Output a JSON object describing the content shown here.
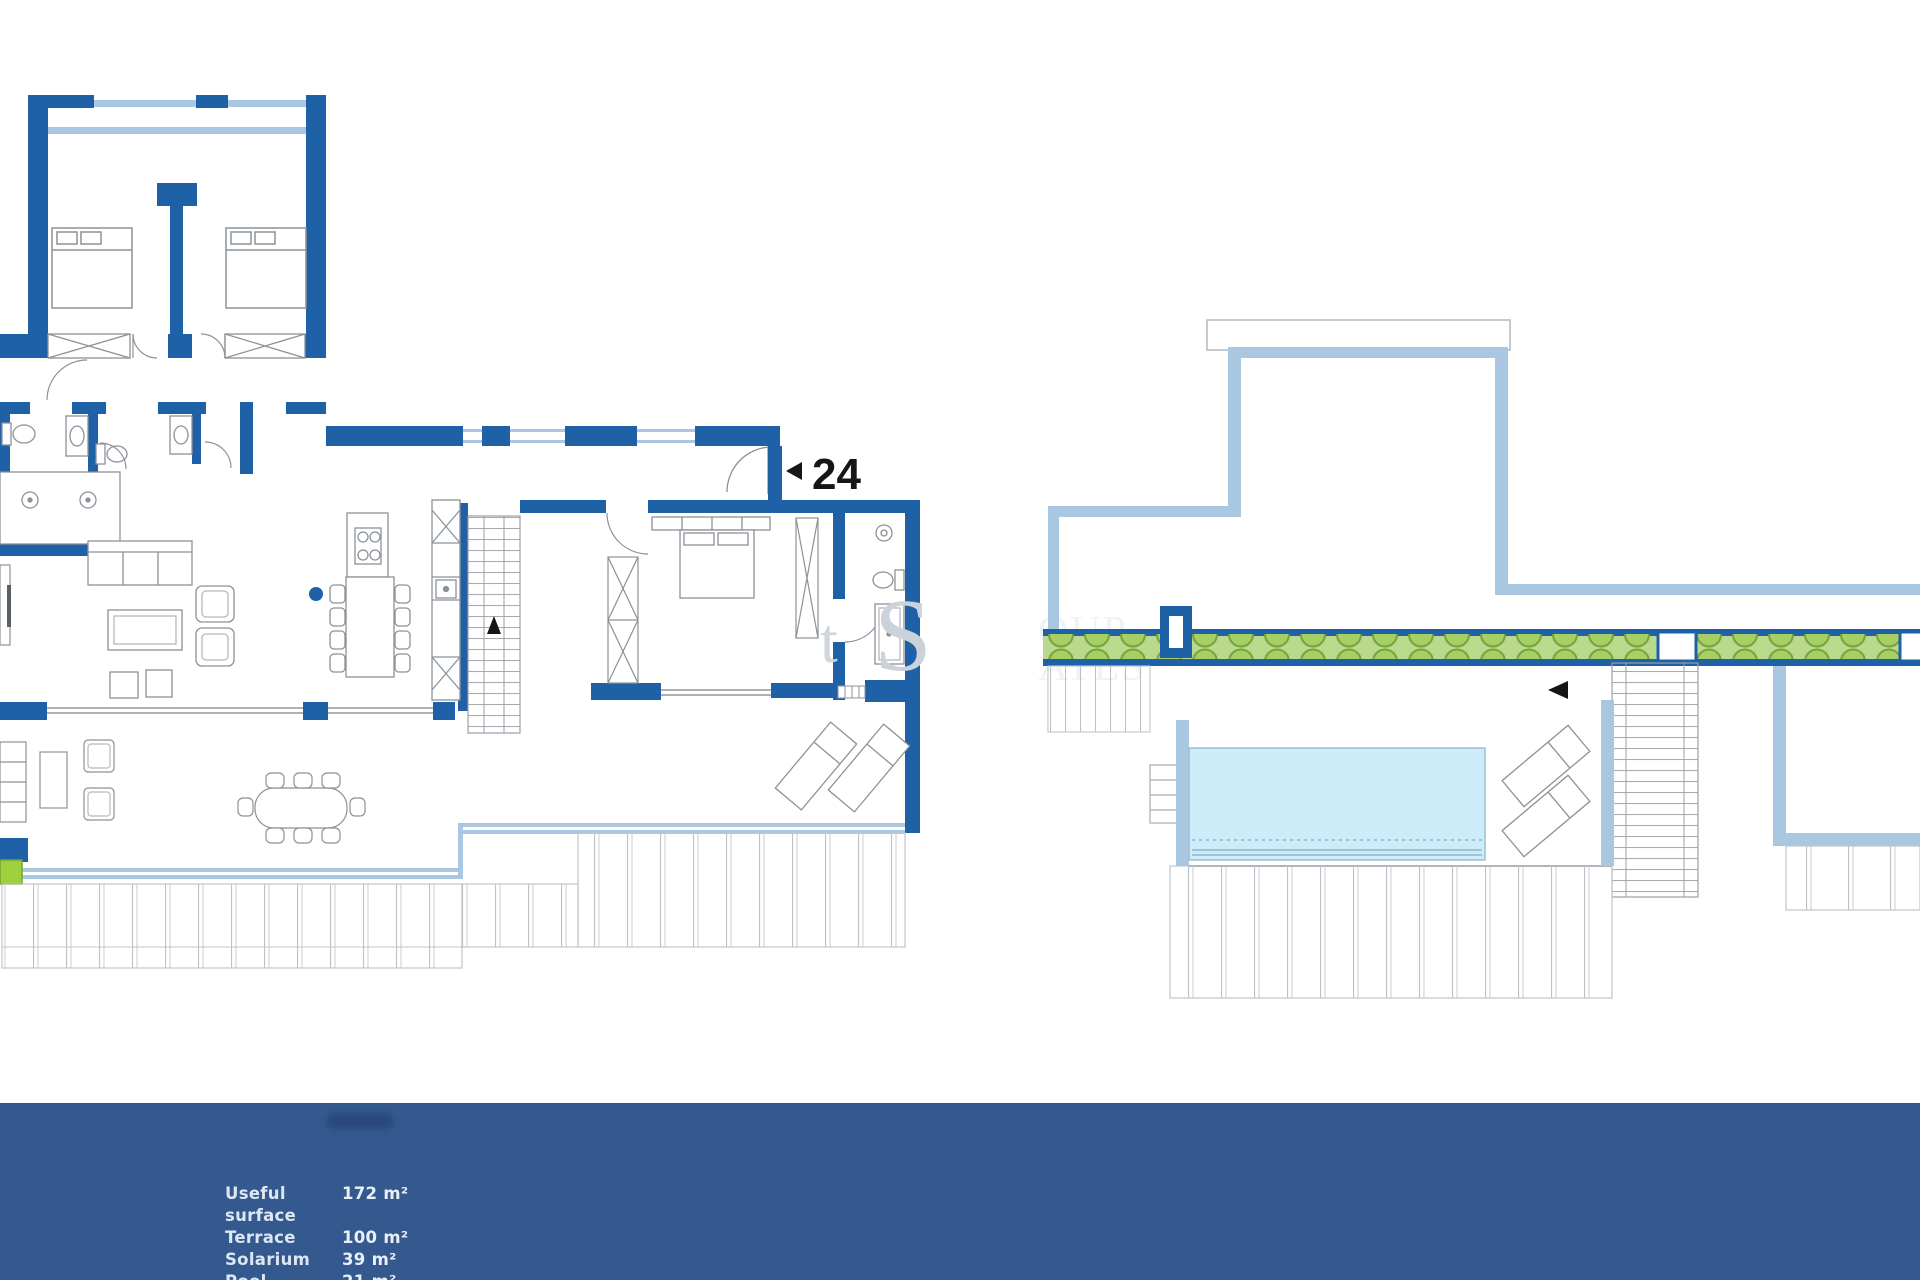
{
  "colors": {
    "wall_blue": "#1e61a7",
    "window_pale_blue": "#a9c7e1",
    "pool_water": "#cdecf9",
    "hedge_band_green": "#b9da8c",
    "plant_circle_green": "#a6cf64",
    "planter_green": "#9ed13e",
    "footer_background": "#33598f",
    "footer_text": "#dde6f3",
    "unit_label_text": "#161616"
  },
  "floor_plan": {
    "unit_number": "24",
    "icons": {
      "entrance_arrow_icon": "triangle-left",
      "stairs_up_arrow_icon": "triangle-up",
      "solarium_stairs_arrow_icon": "triangle-left"
    }
  },
  "watermark": {
    "fragments": {
      "f1": "t",
      "f2": "S",
      "f3": "OUP",
      "f4": "ATES"
    }
  },
  "footer": {
    "stats": [
      {
        "label": "Useful surface",
        "value": "172 m²"
      },
      {
        "label": "Terrace",
        "value": "100 m²"
      },
      {
        "label": "Solarium",
        "value": "39 m²"
      },
      {
        "label": "Pool",
        "value": "21 m²"
      }
    ]
  }
}
